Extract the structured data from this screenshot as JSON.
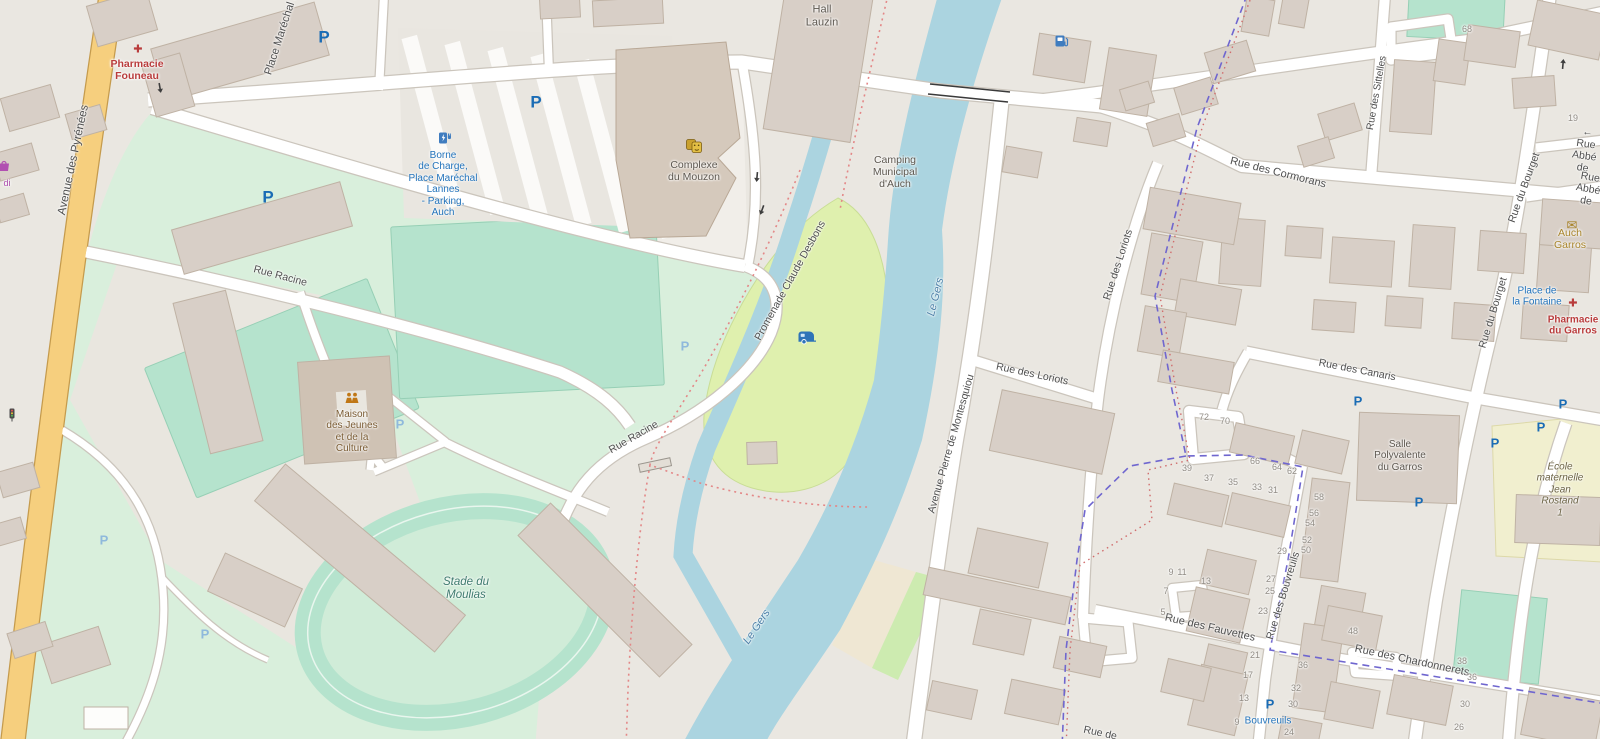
{
  "colors": {
    "street_label": "#4f4f4f",
    "water_label": "#4d80a8",
    "green_label": "#3e7a6e",
    "poi_blue": "#2273bb",
    "poi_red": "#b93c3c",
    "poi_gold": "#a8842a",
    "poi_brown": "#7a5b33",
    "parking_blue": "#1a6cb5",
    "parking_light": "#8fb9dc",
    "water": "#abd4e0",
    "campsite": "#dff0ae",
    "pitch": "#b5e3cd",
    "grass": "#d9efdc",
    "school": "#f1efcf",
    "building": "#d8cfc7",
    "building_stroke": "#bfb2a4",
    "road_fill": "#ffffff",
    "road_casing": "#cbc5bc",
    "road_yellow": "#f6cf7e",
    "road_yellow_casing": "#c59b4d",
    "boundary_purple": "#6f66cf",
    "path_red": "#e38787"
  },
  "icon_glyphs": {
    "parking": "P",
    "pharmacy": "✚",
    "mail": "✉"
  },
  "map": {
    "labels": [
      {
        "name": "street-avenue-des-pyrenees",
        "text": "Avenue des Pyrénées",
        "x": 74,
        "y": 160,
        "rot": -78,
        "cls": "street",
        "size": 11.5
      },
      {
        "name": "street-place-marechal-lannes",
        "text": "Place Maréchal Lannes",
        "x": 286,
        "y": 20,
        "rot": -72,
        "cls": "street",
        "size": 11
      },
      {
        "name": "poi-hall-lauzin",
        "text": "Hall\nLauzin",
        "x": 822,
        "y": 16,
        "rot": 0,
        "cls": "poi-dark",
        "size": 11
      },
      {
        "name": "poi-pharmacie-founeau",
        "text": "Pharmacie\nFouneau",
        "x": 137,
        "y": 71,
        "rot": 0,
        "cls": "poi-red",
        "size": 10.5
      },
      {
        "name": "poi-borne-de-charge",
        "text": "Borne\nde Charge,\nPlace Maréchal\nLannes\n- Parking,\nAuch",
        "x": 443,
        "y": 184,
        "rot": 0,
        "cls": "poi-blue",
        "size": 10
      },
      {
        "name": "poi-complexe-du-mouzon",
        "text": "Complexe\ndu Mouzon",
        "x": 694,
        "y": 172,
        "rot": 0,
        "cls": "poi-dark",
        "size": 10.5
      },
      {
        "name": "poi-camping-municipal",
        "text": "Camping\nMunicipal\nd'Auch",
        "x": 895,
        "y": 173,
        "rot": 0,
        "cls": "poi-dark",
        "size": 10.5
      },
      {
        "name": "street-promenade-claude-desbons",
        "text": "Promenade Claude Desbons",
        "x": 791,
        "y": 281,
        "rot": -61,
        "cls": "street",
        "size": 10.5
      },
      {
        "name": "water-le-gers-1",
        "text": "Le Gers",
        "x": 936,
        "y": 297,
        "rot": -76,
        "cls": "water-label",
        "size": 11
      },
      {
        "name": "water-le-gers-2",
        "text": "Le Gers",
        "x": 757,
        "y": 627,
        "rot": -56,
        "cls": "water-label",
        "size": 11
      },
      {
        "name": "street-rue-racine-1",
        "text": "Rue Racine",
        "x": 280,
        "y": 277,
        "rot": 15,
        "cls": "street",
        "size": 10.5
      },
      {
        "name": "street-rue-racine-2",
        "text": "Rue Racine",
        "x": 634,
        "y": 438,
        "rot": -30,
        "cls": "street",
        "size": 10.5
      },
      {
        "name": "poi-maison-des-jeunes",
        "text": "Maison\ndes Jeunes\net de la\nCulture",
        "x": 352,
        "y": 432,
        "rot": 0,
        "cls": "poi-brown",
        "size": 10
      },
      {
        "name": "poi-stade-du-moulias",
        "text": "Stade du\nMoulias",
        "x": 466,
        "y": 589,
        "rot": 0,
        "cls": "green-label",
        "size": 11.5
      },
      {
        "name": "street-rue-des-cormorans",
        "text": "Rue des Cormorans",
        "x": 1278,
        "y": 173,
        "rot": 14,
        "cls": "street",
        "size": 11
      },
      {
        "name": "street-rue-des-sittelles",
        "text": "Rue des Sittelles",
        "x": 1377,
        "y": 93,
        "rot": -80,
        "cls": "street",
        "size": 10
      },
      {
        "name": "street-rue-abbe-1",
        "text": "← Rue Abbé de",
        "x": 1585,
        "y": 151,
        "rot": 8,
        "cls": "street",
        "size": 10.5
      },
      {
        "name": "street-rue-abbe-2",
        "text": "Rue Abbé de",
        "x": 1588,
        "y": 190,
        "rot": 10,
        "cls": "street",
        "size": 10.5
      },
      {
        "name": "street-rue-du-bourget-1",
        "text": "Rue du Bourget",
        "x": 1525,
        "y": 188,
        "rot": -70,
        "cls": "street",
        "size": 10.5
      },
      {
        "name": "street-rue-du-bourget-2",
        "text": "Rue du Bourget",
        "x": 1494,
        "y": 313,
        "rot": -73,
        "cls": "street",
        "size": 10.5
      },
      {
        "name": "poi-auch-garros",
        "text": "Auch Garros",
        "x": 1570,
        "y": 240,
        "rot": 0,
        "cls": "poi-gold",
        "size": 10.5
      },
      {
        "name": "poi-place-de-la-fontaine",
        "text": "Place de\nla Fontaine",
        "x": 1537,
        "y": 297,
        "rot": 0,
        "cls": "poi-blue",
        "size": 10
      },
      {
        "name": "poi-pharmacie-du-garros",
        "text": "Pharmacie\ndu Garros",
        "x": 1573,
        "y": 326,
        "rot": 0,
        "cls": "poi-red",
        "size": 10
      },
      {
        "name": "street-rue-des-canaris",
        "text": "Rue des Canaris",
        "x": 1357,
        "y": 371,
        "rot": 11,
        "cls": "street",
        "size": 10.5
      },
      {
        "name": "poi-salle-polyvalente",
        "text": "Salle\nPolyvalente\ndu Garros",
        "x": 1400,
        "y": 456,
        "rot": 0,
        "cls": "poi-dark",
        "size": 10
      },
      {
        "name": "poi-ecole-maternelle",
        "text": "École maternelle\nJean Rostand\n1",
        "x": 1560,
        "y": 490,
        "rot": 0,
        "cls": "poi-school",
        "size": 10
      },
      {
        "name": "street-rue-des-loriots-1",
        "text": "Rue des Loriots",
        "x": 1119,
        "y": 265,
        "rot": -72,
        "cls": "street",
        "size": 10.5
      },
      {
        "name": "street-rue-des-loriots-2",
        "text": "Rue des Loriots",
        "x": 1032,
        "y": 375,
        "rot": 12,
        "cls": "street",
        "size": 10.5
      },
      {
        "name": "street-avenue-pierre-de-montesquiou",
        "text": "Avenue Pierre de Montesquiou",
        "x": 952,
        "y": 444,
        "rot": -74,
        "cls": "street",
        "size": 10.5
      },
      {
        "name": "street-rue-des-fauvettes",
        "text": "Rue des Fauvettes",
        "x": 1210,
        "y": 628,
        "rot": 13,
        "cls": "street",
        "size": 11
      },
      {
        "name": "street-rue-des-bouvreuils",
        "text": "Rue des Bouvreuils",
        "x": 1284,
        "y": 596,
        "rot": -73,
        "cls": "street",
        "size": 10.5
      },
      {
        "name": "street-rue-des-chardonnerets",
        "text": "Rue des Chardonnerets",
        "x": 1412,
        "y": 661,
        "rot": 12,
        "cls": "street",
        "size": 11
      },
      {
        "name": "poi-bouvreuils",
        "text": "Bouvreuils",
        "x": 1268,
        "y": 721,
        "rot": 0,
        "cls": "poi-blue",
        "size": 10
      },
      {
        "name": "shop-midi-partial",
        "text": "di",
        "x": 7,
        "y": 183,
        "rot": 0,
        "cls": "poi-purple",
        "size": 9
      },
      {
        "name": "street-rue-de-partial",
        "text": "Rue de",
        "x": 1100,
        "y": 734,
        "rot": 12,
        "cls": "street",
        "size": 10.5
      }
    ],
    "house_numbers": [
      {
        "t": "68",
        "x": 1467,
        "y": 29
      },
      {
        "t": "19",
        "x": 1573,
        "y": 118
      },
      {
        "t": "72",
        "x": 1204,
        "y": 417
      },
      {
        "t": "70",
        "x": 1225,
        "y": 421
      },
      {
        "t": "66",
        "x": 1255,
        "y": 461
      },
      {
        "t": "64",
        "x": 1277,
        "y": 467
      },
      {
        "t": "62",
        "x": 1292,
        "y": 471
      },
      {
        "t": "39",
        "x": 1187,
        "y": 468
      },
      {
        "t": "37",
        "x": 1209,
        "y": 478
      },
      {
        "t": "35",
        "x": 1233,
        "y": 482
      },
      {
        "t": "33",
        "x": 1257,
        "y": 487
      },
      {
        "t": "31",
        "x": 1273,
        "y": 490
      },
      {
        "t": "58",
        "x": 1319,
        "y": 497
      },
      {
        "t": "56",
        "x": 1314,
        "y": 513
      },
      {
        "t": "54",
        "x": 1310,
        "y": 523
      },
      {
        "t": "52",
        "x": 1307,
        "y": 540
      },
      {
        "t": "50",
        "x": 1306,
        "y": 550
      },
      {
        "t": "29",
        "x": 1282,
        "y": 551
      },
      {
        "t": "27",
        "x": 1271,
        "y": 579
      },
      {
        "t": "25",
        "x": 1270,
        "y": 591
      },
      {
        "t": "23",
        "x": 1263,
        "y": 611
      },
      {
        "t": "9",
        "x": 1171,
        "y": 572
      },
      {
        "t": "11",
        "x": 1182,
        "y": 572
      },
      {
        "t": "13",
        "x": 1206,
        "y": 581
      },
      {
        "t": "7",
        "x": 1166,
        "y": 591
      },
      {
        "t": "5",
        "x": 1163,
        "y": 612
      },
      {
        "t": "21",
        "x": 1255,
        "y": 655
      },
      {
        "t": "17",
        "x": 1248,
        "y": 675
      },
      {
        "t": "13",
        "x": 1244,
        "y": 698
      },
      {
        "t": "9",
        "x": 1237,
        "y": 722
      },
      {
        "t": "36",
        "x": 1303,
        "y": 665
      },
      {
        "t": "32",
        "x": 1296,
        "y": 688
      },
      {
        "t": "30",
        "x": 1293,
        "y": 704
      },
      {
        "t": "24",
        "x": 1289,
        "y": 732
      },
      {
        "t": "48",
        "x": 1353,
        "y": 631
      },
      {
        "t": "38",
        "x": 1462,
        "y": 661
      },
      {
        "t": "36",
        "x": 1472,
        "y": 677
      },
      {
        "t": "30",
        "x": 1465,
        "y": 704
      },
      {
        "t": "26",
        "x": 1459,
        "y": 727
      }
    ],
    "icons": [
      {
        "type": "pharmacy",
        "x": 138,
        "y": 50
      },
      {
        "type": "pharmacy",
        "x": 1573,
        "y": 304
      },
      {
        "type": "mail",
        "x": 1572,
        "y": 225
      },
      {
        "type": "fuel",
        "x": 1062,
        "y": 43
      },
      {
        "type": "charging",
        "x": 445,
        "y": 140
      },
      {
        "type": "theatre",
        "x": 694,
        "y": 148
      },
      {
        "type": "caravan",
        "x": 807,
        "y": 340
      },
      {
        "type": "community",
        "x": 352,
        "y": 400
      },
      {
        "type": "signal",
        "x": 12,
        "y": 417
      },
      {
        "type": "shop",
        "x": 4,
        "y": 168
      },
      {
        "type": "parking",
        "x": 324,
        "y": 37,
        "variant": "large"
      },
      {
        "type": "parking",
        "x": 536,
        "y": 102,
        "variant": "large"
      },
      {
        "type": "parking",
        "x": 268,
        "y": 197,
        "variant": "large"
      },
      {
        "type": "parking",
        "x": 1358,
        "y": 401
      },
      {
        "type": "parking",
        "x": 1563,
        "y": 404
      },
      {
        "type": "parking",
        "x": 1541,
        "y": 427
      },
      {
        "type": "parking",
        "x": 1495,
        "y": 443
      },
      {
        "type": "parking",
        "x": 1419,
        "y": 502
      },
      {
        "type": "parking",
        "x": 1270,
        "y": 704
      },
      {
        "type": "parking",
        "x": 400,
        "y": 424,
        "variant": "light"
      },
      {
        "type": "parking",
        "x": 685,
        "y": 346,
        "variant": "light"
      },
      {
        "type": "parking",
        "x": 104,
        "y": 540,
        "variant": "light"
      },
      {
        "type": "parking",
        "x": 205,
        "y": 634,
        "variant": "light"
      },
      {
        "type": "oneway",
        "x": 757,
        "y": 177,
        "rot": 95
      },
      {
        "type": "oneway",
        "x": 762,
        "y": 210,
        "rot": 110
      },
      {
        "type": "oneway",
        "x": 1563,
        "y": 64,
        "rot": -85
      },
      {
        "type": "oneway",
        "x": 160,
        "y": 88,
        "rot": 80
      }
    ]
  }
}
